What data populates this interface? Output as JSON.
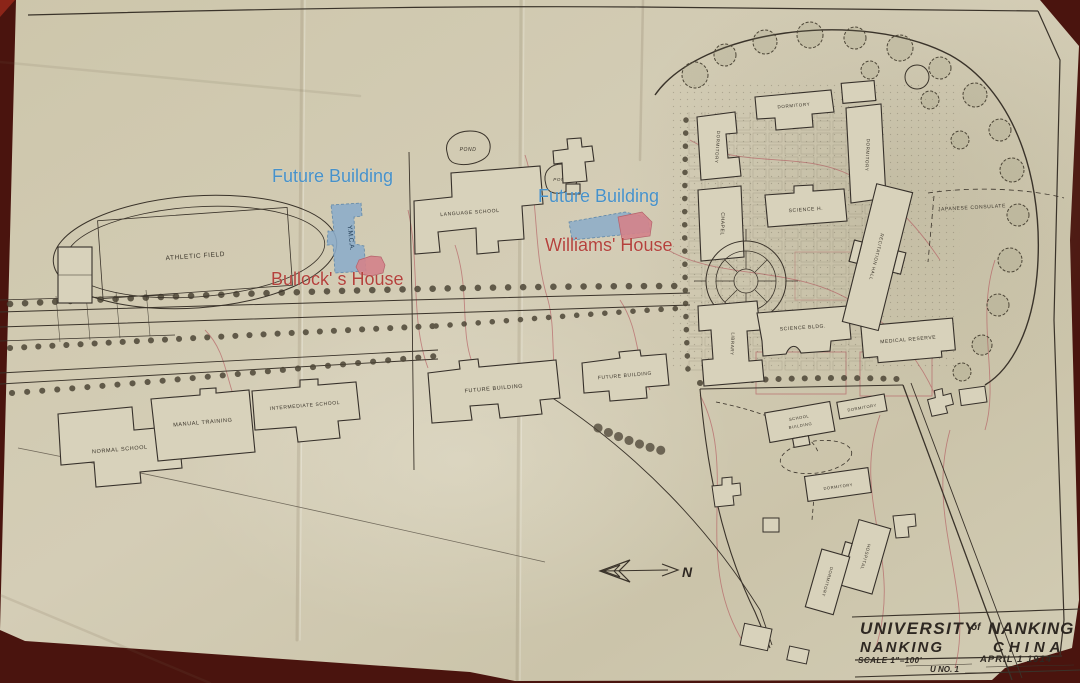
{
  "annotations": {
    "future_building_1": "Future Building",
    "bullocks_house": "Bullock' s House",
    "future_building_2": "Future Building",
    "williams_house": "Williams' House",
    "colors": {
      "blue_text": "#4791c9",
      "blue_fill": "#8bacc9",
      "red_text": "#b4423c",
      "pink_fill": "#d2838b"
    }
  },
  "map_labels": {
    "athletic_field": "ATHLETIC FIELD",
    "normal_school": "NORMAL SCHOOL",
    "manual_training": "MANUAL TRAINING",
    "intermediate_school": "INTERMEDIATE SCHOOL",
    "future_building_sw": "FUTURE BUILDING",
    "future_building_s": "FUTURE BUILDING",
    "language_school": "LANGUAGE SCHOOL",
    "pond_west": "POND",
    "pond_east": "POND",
    "ymca": "Y.M.C.A.",
    "dormitory_nw": "DORMITORY",
    "dormitory_n": "DORMITORY",
    "dormitory_e": "DORMITORY",
    "chapel": "CHAPEL",
    "science_hall": "SCIENCE H.",
    "library": "LIBRARY",
    "science_bldg": "SCIENCE BLDG.",
    "medical_reserve": "MEDICAL RESERVE",
    "recitation_hall": "RECITATION HALL",
    "japanese_consulate": "JAPANESE CONSULATE",
    "school_building_l1": "SCHOOL",
    "school_building_l2": "BUILDING",
    "dormitory_se_top": "DORMITORY",
    "dormitory_se_mid": "DORMITORY",
    "hospital": "HOSPITAL",
    "dormitory_se_low": "DORMITORY",
    "north_indicator": "N"
  },
  "title_block": {
    "university": "UNIVERSITY",
    "of": "of",
    "nanking": "NANKING",
    "city": "NANKING",
    "country": "CHINA",
    "scale": "SCALE 1\"=100'",
    "date": "APRIL 1 1914",
    "sheet": "U  NO. 1"
  },
  "colors": {
    "paper": "#cfc8b0",
    "backdrop": "#4a140e",
    "ink": "#3a332a",
    "contour_red": "#b2555c"
  }
}
